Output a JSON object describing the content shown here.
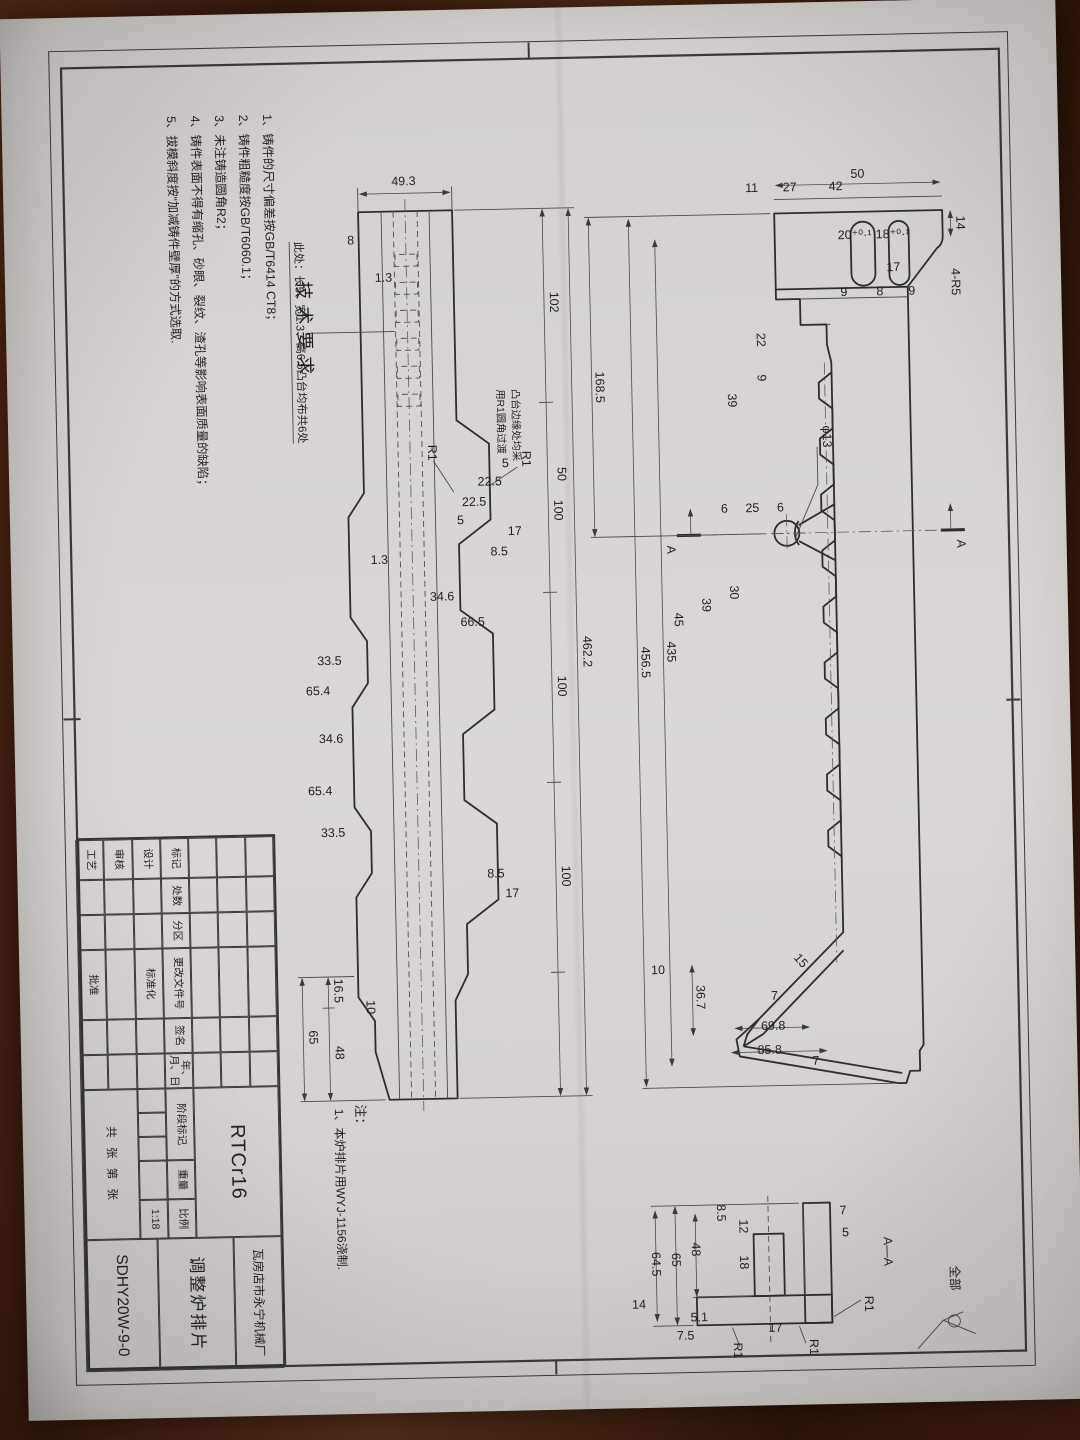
{
  "meta": {
    "paper_color": "#d8d5d1",
    "wood_color": "#47200f",
    "line_color": "#2d2d2d"
  },
  "tech": {
    "title": "技术要求",
    "items": [
      "1、铸件的尺寸偏差按GB/T6414 CT8；",
      "2、铸件粗糙度按GB/T6060.1；",
      "3、未注铸造圆角R2；",
      "4、铸件表面不得有缩孔、砂眼、裂纹、渣孔等影响表面质量的缺陷；",
      "5、拔模斜度按“加减铸件壁厚”的方式选取."
    ]
  },
  "notes": {
    "title": "注：",
    "item1": "1、本炉排片用WYJ-1156浇制.",
    "boss_note": "此处：长5、宽1.3、高6.5凸台均布共6处",
    "fillet_note_line1": "凸台边缘处均采",
    "fillet_note_line2": "用R1圆角过渡"
  },
  "title_block": {
    "header_cells": [
      "标记",
      "处数",
      "分区",
      "更改文件号",
      "签名",
      "年、月、日"
    ],
    "design": "设计",
    "standardization": "标准化",
    "review": "审核",
    "process": "工艺",
    "approve": "批准",
    "stage_label": "阶段标记",
    "weight_label": "重量",
    "scale_label": "比例",
    "scale_value": "1:18",
    "sheet_label": "共 张 第 张",
    "material": "RTCr16",
    "company": "瓦房店市永宁机械厂",
    "part_name": "调整炉排片",
    "drawing_no": "SDHY20W-9-0"
  },
  "annotations": [
    {
      "t": "50",
      "x": 146,
      "y": 156,
      "r": -90
    },
    {
      "t": "42",
      "x": 158,
      "y": 178,
      "r": -90
    },
    {
      "t": "27",
      "x": 158,
      "y": 224,
      "r": -90
    },
    {
      "t": "11",
      "x": 158,
      "y": 262,
      "r": -90
    },
    {
      "t": "14",
      "x": 193,
      "y": 58,
      "r": 0
    },
    {
      "t": "4-R5",
      "x": 252,
      "y": 64,
      "r": 0
    },
    {
      "t": "17",
      "x": 240,
      "y": 122,
      "r": -90
    },
    {
      "t": "9",
      "x": 264,
      "y": 104,
      "r": -90
    },
    {
      "t": "18⁺⁰·¹",
      "x": 207,
      "y": 122,
      "r": -90,
      "s": 10.5
    },
    {
      "t": "8",
      "x": 264,
      "y": 136,
      "r": -90
    },
    {
      "t": "20⁺⁰·¹",
      "x": 207,
      "y": 160,
      "r": -90,
      "s": 10.5
    },
    {
      "t": "9",
      "x": 264,
      "y": 172,
      "r": -90
    },
    {
      "t": "22",
      "x": 306,
      "y": 260,
      "r": 0
    },
    {
      "t": "9",
      "x": 344,
      "y": 260,
      "r": 0
    },
    {
      "t": "39",
      "x": 366,
      "y": 290,
      "r": 0
    },
    {
      "t": "168.5",
      "x": 350,
      "y": 422,
      "r": 0
    },
    {
      "t": "φ13",
      "x": 404,
      "y": 196,
      "r": 0
    },
    {
      "t": "6",
      "x": 478,
      "y": 240,
      "r": -90
    },
    {
      "t": "25",
      "x": 478,
      "y": 268,
      "r": -90
    },
    {
      "t": "6",
      "x": 478,
      "y": 296,
      "r": -90
    },
    {
      "t": "30",
      "x": 558,
      "y": 292,
      "r": 0
    },
    {
      "t": "39",
      "x": 570,
      "y": 320,
      "r": 0
    },
    {
      "t": "45",
      "x": 584,
      "y": 348,
      "r": 0
    },
    {
      "t": "435",
      "x": 616,
      "y": 356,
      "r": 0
    },
    {
      "t": "456.5",
      "x": 626,
      "y": 382,
      "r": 0
    },
    {
      "t": "10",
      "x": 938,
      "y": 372,
      "r": -90
    },
    {
      "t": "36.7",
      "x": 962,
      "y": 334,
      "r": 0
    },
    {
      "t": "15",
      "x": 930,
      "y": 232,
      "r": -40
    },
    {
      "t": "7",
      "x": 966,
      "y": 256,
      "r": -90
    },
    {
      "t": "7",
      "x": 1032,
      "y": 216,
      "r": -90
    },
    {
      "t": "69.8",
      "x": 996,
      "y": 258,
      "r": -90
    },
    {
      "t": "85.8",
      "x": 1020,
      "y": 262,
      "r": -90
    },
    {
      "t": "A",
      "x": 514,
      "y": 64,
      "r": 0,
      "s": 15
    },
    {
      "t": "A",
      "x": 514,
      "y": 354,
      "r": 0,
      "s": 15
    },
    {
      "t": "49.3",
      "x": 144,
      "y": 610,
      "r": -90
    },
    {
      "t": "8",
      "x": 202,
      "y": 664,
      "r": -90
    },
    {
      "t": "1.3",
      "x": 240,
      "y": 632,
      "r": -90
    },
    {
      "t": "102",
      "x": 264,
      "y": 466,
      "r": 0
    },
    {
      "t": "50",
      "x": 436,
      "y": 462,
      "r": 0
    },
    {
      "t": "100",
      "x": 472,
      "y": 466,
      "r": 0
    },
    {
      "t": "100",
      "x": 648,
      "y": 466,
      "r": 0
    },
    {
      "t": "100",
      "x": 838,
      "y": 466,
      "r": 0
    },
    {
      "t": "462.2",
      "x": 614,
      "y": 440,
      "r": 0
    },
    {
      "t": "5",
      "x": 428,
      "y": 514,
      "r": -90
    },
    {
      "t": "22.5",
      "x": 446,
      "y": 530,
      "r": -90
    },
    {
      "t": "22.5",
      "x": 466,
      "y": 546,
      "r": -90
    },
    {
      "t": "5",
      "x": 484,
      "y": 560,
      "r": -90
    },
    {
      "t": "1.3",
      "x": 522,
      "y": 642,
      "r": -90
    },
    {
      "t": "17",
      "x": 496,
      "y": 506,
      "r": -90
    },
    {
      "t": "8.5",
      "x": 516,
      "y": 522,
      "r": -90
    },
    {
      "t": "66.5",
      "x": 586,
      "y": 550,
      "r": -90
    },
    {
      "t": "34.6",
      "x": 560,
      "y": 580,
      "r": -90
    },
    {
      "t": "33.5",
      "x": 622,
      "y": 694,
      "r": -90
    },
    {
      "t": "65.4",
      "x": 652,
      "y": 706,
      "r": -90
    },
    {
      "t": "34.6",
      "x": 700,
      "y": 694,
      "r": -90
    },
    {
      "t": "65.4",
      "x": 752,
      "y": 706,
      "r": -90
    },
    {
      "t": "33.5",
      "x": 794,
      "y": 694,
      "r": -90
    },
    {
      "t": "8.5",
      "x": 838,
      "y": 532,
      "r": -90
    },
    {
      "t": "17",
      "x": 858,
      "y": 516,
      "r": -90
    },
    {
      "t": "R1",
      "x": 420,
      "y": 497,
      "r": 0
    },
    {
      "t": "R1",
      "x": 412,
      "y": 591,
      "r": 0
    },
    {
      "t": "10",
      "x": 965,
      "y": 664,
      "r": 0
    },
    {
      "t": "16.5",
      "x": 948,
      "y": 696,
      "r": 0
    },
    {
      "t": "48",
      "x": 1010,
      "y": 696,
      "r": 0
    },
    {
      "t": "65",
      "x": 994,
      "y": 722,
      "r": 0
    },
    {
      "t": "A—A",
      "x": 1220,
      "y": 152,
      "r": 0,
      "s": 15
    },
    {
      "t": "7",
      "x": 1182,
      "y": 192,
      "r": -90
    },
    {
      "t": "5",
      "x": 1204,
      "y": 190,
      "r": -90
    },
    {
      "t": "R1",
      "x": 1272,
      "y": 172,
      "r": 0
    },
    {
      "t": "65",
      "x": 1224,
      "y": 364,
      "r": 0
    },
    {
      "t": "64.5",
      "x": 1228,
      "y": 384,
      "r": 0
    },
    {
      "t": "48",
      "x": 1214,
      "y": 344,
      "r": 0
    },
    {
      "t": "12",
      "x": 1192,
      "y": 296,
      "r": 0
    },
    {
      "t": "18",
      "x": 1228,
      "y": 296,
      "r": 0
    },
    {
      "t": "8.5",
      "x": 1178,
      "y": 318,
      "r": 0
    },
    {
      "t": "17",
      "x": 1298,
      "y": 262,
      "r": -90
    },
    {
      "t": "R1",
      "x": 1314,
      "y": 228,
      "r": 0
    },
    {
      "t": "R1",
      "x": 1316,
      "y": 304,
      "r": 0
    },
    {
      "t": "5.1",
      "x": 1286,
      "y": 338,
      "r": -90
    },
    {
      "t": "7.5",
      "x": 1304,
      "y": 352,
      "r": -90
    },
    {
      "t": "14",
      "x": 1272,
      "y": 398,
      "r": -90
    },
    {
      "t": "全部",
      "x": 1248,
      "y": 86,
      "r": 0,
      "s": 14
    }
  ]
}
